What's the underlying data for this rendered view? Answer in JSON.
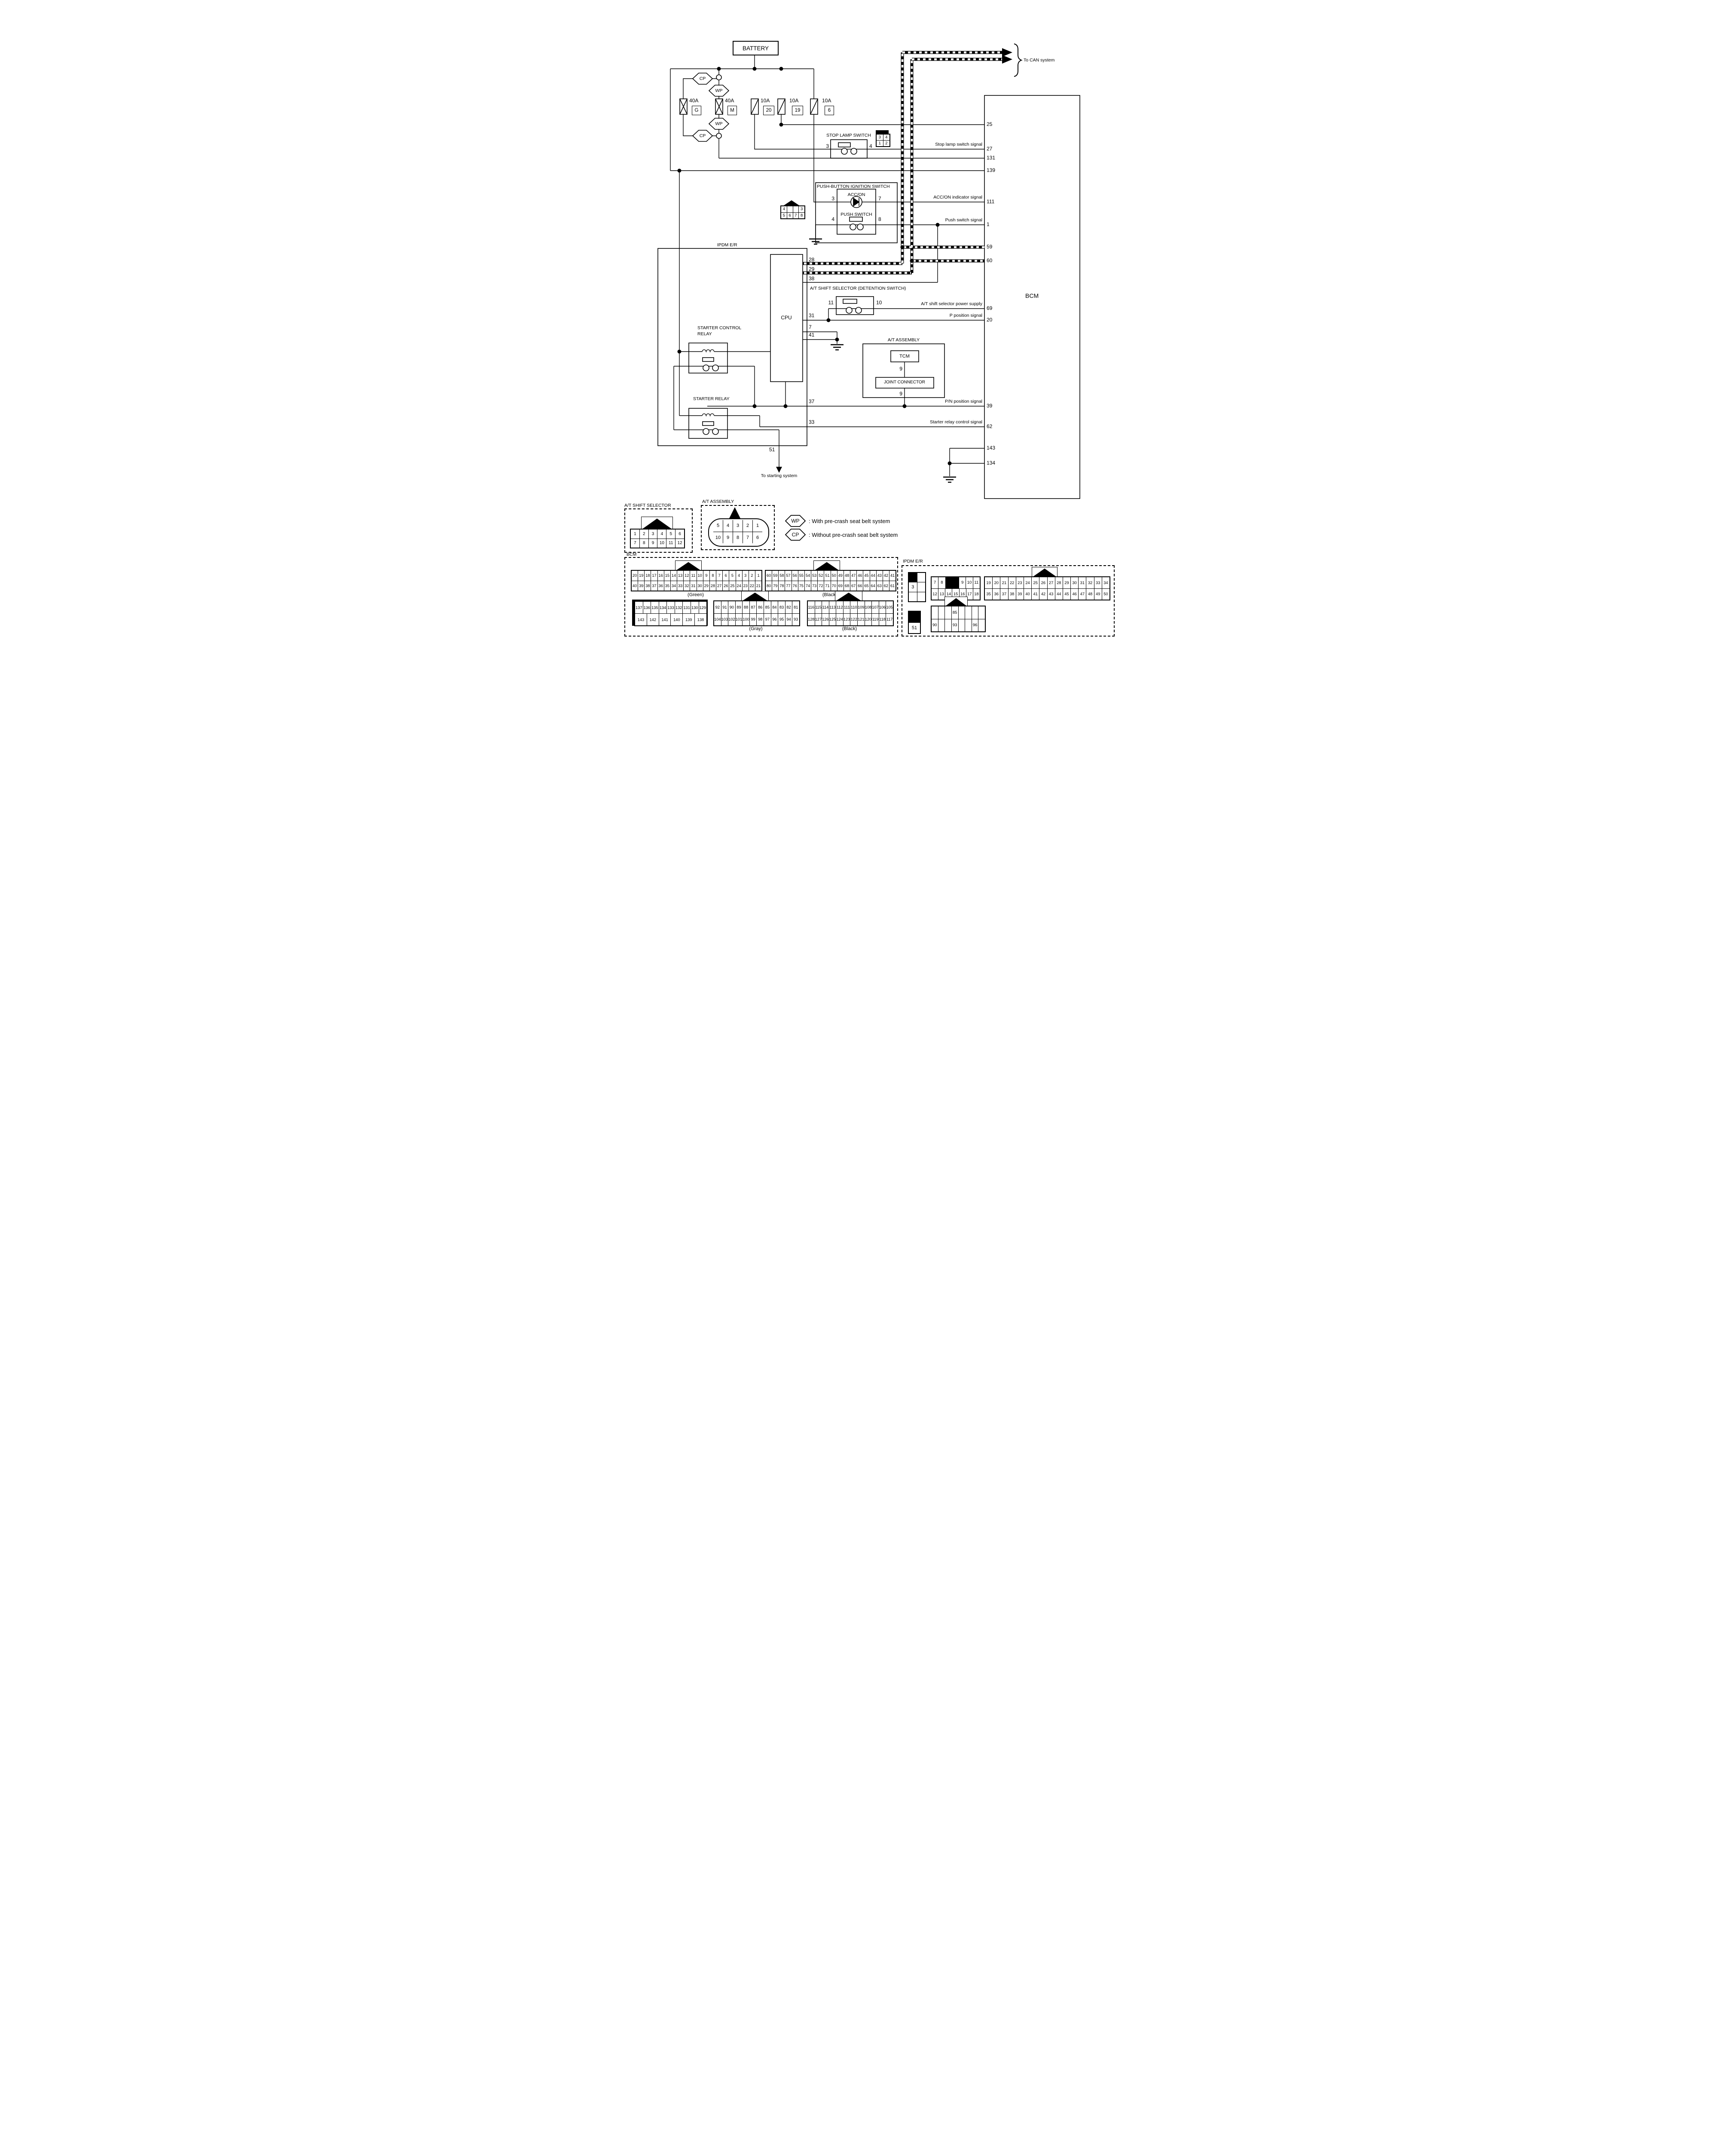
{
  "diagram": {
    "battery": "BATTERY",
    "to_can": "To CAN system",
    "bcm": "BCM",
    "ipdm": "IPDM E/R",
    "cpu": "CPU",
    "stop_lamp_switch": "STOP LAMP SWITCH",
    "push_button_ignition": "PUSH-BUTTON IGNITION SWITCH",
    "acc_on": "ACC/ON",
    "push_switch": "PUSH SWITCH",
    "detention": "A/T SHIFT SELECTOR (DETENTION SWITCH)",
    "at_assembly": "A/T ASSEMBLY",
    "tcm": "TCM",
    "joint_connector": "JOINT CONNECTOR",
    "starter_control_relay_line1": "STARTER CONTROL",
    "starter_control_relay_line2": "RELAY",
    "starter_relay": "STARTER RELAY",
    "to_starting": "To starting system"
  },
  "fuses": {
    "g_amp": "40A",
    "g": "G",
    "m_amp": "40A",
    "m": "M",
    "f20_amp": "10A",
    "f20": "20",
    "f19_amp": "10A",
    "f19": "19",
    "f6_amp": "10A",
    "f6": "6"
  },
  "legend": {
    "wp": "WP",
    "cp": "CP",
    "wp_desc": ": With pre-crash seat belt system",
    "cp_desc": ": Without pre-crash seat belt system"
  },
  "signals": {
    "stop_lamp": "Stop lamp switch signal",
    "acc_on": "ACC/ON indicator signal",
    "push": "Push switch signal",
    "shift_power": "A/T shift selector power supply",
    "p_position": "P position signal",
    "pn_position": "P/N position signal",
    "starter_relay_control": "Starter relay control signal"
  },
  "bcm_pins": {
    "p25": "25",
    "p27": "27",
    "p131": "131",
    "p139": "139",
    "p111": "111",
    "p1": "1",
    "p59": "59",
    "p60": "60",
    "p69": "69",
    "p20": "20",
    "p39": "39",
    "p62": "62",
    "p143": "143",
    "p134": "134"
  },
  "ipdm_pins": {
    "p28": "28",
    "p29": "29",
    "p38": "38",
    "p31": "31",
    "p7": "7",
    "p41": "41",
    "p37": "37",
    "p33": "33",
    "p51": "51"
  },
  "component_pins": {
    "stop3": "3",
    "stop4": "4",
    "ign3": "3",
    "ign7": "7",
    "ign4": "4",
    "ign8": "8",
    "det11": "11",
    "det10": "10",
    "tcm9": "9",
    "joint9": "9"
  },
  "connectors": {
    "bcm_section_label": "BCM",
    "ipdm_section_label": "IPDM E/R",
    "at_shift_selector": {
      "title": "A/T SHIFT SELECTOR",
      "grid": [
        [
          "1",
          "2",
          "3",
          "4",
          "5",
          "6"
        ],
        [
          "7",
          "8",
          "9",
          "10",
          "11",
          "12"
        ]
      ]
    },
    "at_assembly": {
      "title": "A/T ASSEMBLY",
      "grid": [
        [
          "5",
          "4",
          "3",
          "2",
          "1"
        ],
        [
          "10",
          "9",
          "8",
          "7",
          "6"
        ]
      ]
    },
    "green": {
      "color": "(Green)",
      "grid": [
        [
          "20",
          "19",
          "18",
          "17",
          "16",
          "15",
          "14",
          "13",
          "12",
          "11",
          "10",
          "9",
          "8",
          "7",
          "6",
          "5",
          "4",
          "3",
          "2",
          "1"
        ],
        [
          "40",
          "39",
          "38",
          "37",
          "36",
          "35",
          "34",
          "33",
          "32",
          "31",
          "30",
          "29",
          "28",
          "27",
          "26",
          "25",
          "24",
          "23",
          "22",
          "21"
        ]
      ]
    },
    "black1": {
      "color": "(Black)",
      "grid": [
        [
          "60",
          "59",
          "58",
          "57",
          "56",
          "55",
          "54",
          "53",
          "52",
          "51",
          "50",
          "49",
          "48",
          "47",
          "46",
          "45",
          "44",
          "43",
          "42",
          "41"
        ],
        [
          "80",
          "79",
          "78",
          "77",
          "76",
          "75",
          "74",
          "73",
          "72",
          "71",
          "70",
          "69",
          "68",
          "67",
          "66",
          "65",
          "64",
          "63",
          "62",
          "61"
        ]
      ]
    },
    "c137": {
      "grid": [
        [
          "137",
          "136",
          "135",
          "134",
          "133",
          "132",
          "131",
          "130",
          "129"
        ],
        [
          "143",
          "142",
          "141",
          "140",
          "139",
          "138"
        ]
      ]
    },
    "gray": {
      "color": "(Gray)",
      "grid": [
        [
          "92",
          "91",
          "90",
          "89",
          "88",
          "87",
          "86",
          "85",
          "84",
          "83",
          "82",
          "81"
        ],
        [
          "104",
          "103",
          "102",
          "101",
          "100",
          "99",
          "98",
          "97",
          "96",
          "95",
          "94",
          "93"
        ]
      ]
    },
    "black2": {
      "color": "(Black)",
      "grid": [
        [
          "116",
          "115",
          "114",
          "113",
          "112",
          "111",
          "110",
          "109",
          "108",
          "107",
          "106",
          "105"
        ],
        [
          "128",
          "127",
          "126",
          "125",
          "124",
          "123",
          "122",
          "121",
          "120",
          "119",
          "118",
          "117"
        ]
      ]
    },
    "ipdm3": {
      "grid": [
        [
          "#",
          ""
        ],
        [
          "3",
          ""
        ],
        [
          "",
          ""
        ]
      ]
    },
    "ipdm718": {
      "grid": [
        [
          "7",
          "8",
          "#2",
          "9",
          "10",
          "11"
        ],
        [
          "12",
          "13",
          "14",
          "15",
          "16",
          "17",
          "18"
        ]
      ]
    },
    "ipdm1950": {
      "grid": [
        [
          "19",
          "20",
          "21",
          "22",
          "23",
          "24",
          "25",
          "26",
          "27",
          "28",
          "29",
          "30",
          "31",
          "32",
          "33",
          "34"
        ],
        [
          "35",
          "36",
          "37",
          "38",
          "39",
          "40",
          "41",
          "42",
          "43",
          "44",
          "45",
          "46",
          "47",
          "48",
          "49",
          "50"
        ]
      ]
    },
    "ipdm51": {
      "grid": [
        [
          "#"
        ],
        [
          "51"
        ]
      ]
    },
    "ipdm85": {
      "grid": [
        [
          "",
          "",
          "",
          "85",
          "",
          "",
          "",
          ""
        ],
        [
          "90",
          "",
          "",
          "93",
          "",
          "",
          "96",
          ""
        ]
      ]
    },
    "ign_conn": {
      "grid": [
        [
          "4",
          "",
          "",
          "3"
        ],
        [
          "5",
          "6",
          "7",
          "8"
        ]
      ]
    },
    "stop_conn": {
      "grid": [
        [
          "3",
          "4"
        ],
        [
          "1",
          "2"
        ]
      ]
    }
  }
}
